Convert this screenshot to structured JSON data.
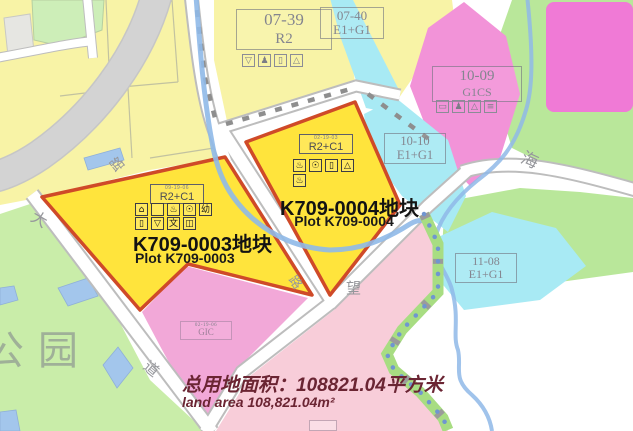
{
  "park_label": "公园",
  "road_labels": {
    "da": "大",
    "dao": "道",
    "lu_nw": "路",
    "lu_mid": "路",
    "wang": "望",
    "hai": "海"
  },
  "parcels": {
    "p0739": {
      "code": "07-39",
      "zone": "R2",
      "icons": [
        "▽",
        "♟",
        "▯",
        "△"
      ]
    },
    "p0740": {
      "code": "07-40",
      "zone": "E1+G1"
    },
    "p1009": {
      "code": "10-09",
      "zone": "G1CS",
      "icons": [
        "▭",
        "♟",
        "△",
        "≡"
      ]
    },
    "p1010": {
      "code": "10-10",
      "zone": "E1+G1"
    },
    "p1108": {
      "code": "11-08",
      "zone": "E1+G1"
    },
    "gic": {
      "small": "02-19-06",
      "zone": "GIC"
    }
  },
  "plots": {
    "k709_0003": {
      "small": "09-19-06",
      "zone": "R2+C1",
      "icons1": [
        "⌂",
        "",
        "♨",
        "☉",
        "幼"
      ],
      "icons2": [
        "▯",
        "▽",
        "文",
        "◫"
      ],
      "title": "K709-0003地块",
      "subtitle": "Plot K709-0003"
    },
    "k709_0004": {
      "small": "02-19-03",
      "zone": "R2+C1",
      "icons1": [
        "♨",
        "☉",
        "▯",
        "△"
      ],
      "icons2": [
        "♨"
      ],
      "title": "K709-0004地块",
      "subtitle": "Plot K709-0004"
    }
  },
  "footer": {
    "cn": "总用地面积：108821.04平方米",
    "en": "land area 108,821.04m²"
  },
  "colors": {
    "plot_fill": "#ffe43c",
    "plot_border": "#cf4a28",
    "residential_pale": "#f8f3a6",
    "park_green": "#c9eda9",
    "pink_g1cs": "#f293d8",
    "cyan_e1g1": "#a8eaf4",
    "soft_pink": "#f8cdd9",
    "gic_pink": "#f2a8d8",
    "stream_blue": "#8fb9e8",
    "footer_text": "#6b2533"
  }
}
